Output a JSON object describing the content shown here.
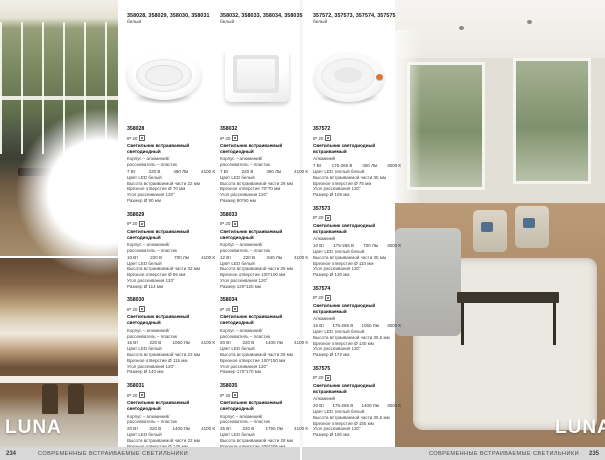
{
  "brand": "LUNA",
  "footer": {
    "left_page": "234",
    "right_page": "235",
    "section_title": "СОВРЕМЕННЫЕ ВСТРАИВАЕМЫЕ СВЕТИЛЬНИКИ"
  },
  "groups": [
    {
      "codes": "358028, 358029, 358030, 358031",
      "finish": "белый"
    },
    {
      "codes": "358032, 358033, 358034, 358035",
      "finish": "белый"
    },
    {
      "codes": "357572, 357573, 357574, 357575",
      "finish": "белый"
    }
  ],
  "columns": [
    {
      "products": [
        {
          "code": "358028",
          "ip": "IP 20",
          "title": "Светильник встраиваемый светодиодный",
          "material": "Корпус – алюминий/",
          "material2": "рассеиватель – пластик",
          "watt": "7 Вт",
          "volt": "220 В",
          "lumen": "490 Лм",
          "kelvin": "4100 К",
          "led_color": "Цвет LED белый",
          "height": "Высота встраиваемой части 22 мм",
          "cutout": "Врезное отверстие Ø 70 мм",
          "angle": "Угол рассеивания 120°",
          "size": "Размер Ø 90 мм"
        },
        {
          "code": "358029",
          "ip": "IP 20",
          "title": "Светильник встраиваемый светодиодный",
          "material": "Корпус – алюминий/",
          "material2": "рассеиватель – пластик",
          "watt": "10 Вт",
          "volt": "220 В",
          "lumen": "700 Лм",
          "kelvin": "4100 К",
          "led_color": "Цвет LED белый",
          "height": "Высота встраиваемой части 32 мм",
          "cutout": "Врезное отверстие Ø 85 мм",
          "angle": "Угол рассеивания 120°",
          "size": "Размер Ø 114 мм"
        },
        {
          "code": "358030",
          "ip": "IP 20",
          "title": "Светильник встраиваемый светодиодный",
          "material": "Корпус – алюминий/",
          "material2": "рассеиватель – пластик",
          "watt": "15 Вт",
          "volt": "220 В",
          "lumen": "1050 Лм",
          "kelvin": "4100 К",
          "led_color": "Цвет LED белый",
          "height": "Высота встраиваемой части 22 мм",
          "cutout": "Врезное отверстие Ø 115 мм",
          "angle": "Угол рассеивания 120°",
          "size": "Размер Ø 140 мм"
        },
        {
          "code": "358031",
          "ip": "IP 20",
          "title": "Светильник встраиваемый светодиодный",
          "material": "Корпус – алюминий/",
          "material2": "рассеиватель – пластик",
          "watt": "20 Вт",
          "volt": "220 В",
          "lumen": "1400 Лм",
          "kelvin": "4100 К",
          "led_color": "Цвет LED белый",
          "height": "Высота встраиваемой части 22 мм",
          "cutout": "Врезное отверстие Ø 145 мм",
          "angle": "Угол рассеивания 120°",
          "size": "Размер Ø 180 мм"
        }
      ]
    },
    {
      "products": [
        {
          "code": "358032",
          "ip": "IP 20",
          "title": "Светильник встраиваемый светодиодный",
          "material": "Корпус – алюминий/",
          "material2": "рассеиватель – пластик",
          "watt": "7 Вт",
          "volt": "220 В",
          "lumen": "490 Лм",
          "kelvin": "4100 К",
          "led_color": "Цвет LED белый",
          "height": "Высота встраиваемой части 28 мм",
          "cutout": "Врезное отверстие 70*70 мм",
          "angle": "Угол рассеивания 120°",
          "size": "Размер 90*90 мм"
        },
        {
          "code": "358033",
          "ip": "IP 20",
          "title": "Светильник встраиваемый светодиодный",
          "material": "Корпус – алюминий/",
          "material2": "рассеиватель – пластик",
          "watt": "12 Вт",
          "volt": "220 В",
          "lumen": "840 Лм",
          "kelvin": "4100 К",
          "led_color": "Цвет LED белый",
          "height": "Высота встраиваемой части 28 мм",
          "cutout": "Врезное отверстие 100*100 мм",
          "angle": "Угол рассеивания 120°",
          "size": "Размер 120*120 мм"
        },
        {
          "code": "358034",
          "ip": "IP 20",
          "title": "Светильник встраиваемый светодиодный",
          "material": "Корпус – алюминий/",
          "material2": "рассеиватель – пластик",
          "watt": "20 Вт",
          "volt": "220 В",
          "lumen": "1400 Лм",
          "kelvin": "4100 К",
          "led_color": "Цвет LED белый",
          "height": "Высота встраиваемой части 28 мм",
          "cutout": "Врезное отверстие 150*150 мм",
          "angle": "Угол рассеивания 120°",
          "size": "Размер 170*170 мм"
        },
        {
          "code": "358035",
          "ip": "IP 20",
          "title": "Светильник встраиваемый светодиодный",
          "material": "Корпус – алюминий/",
          "material2": "рассеиватель – пластик",
          "watt": "25 Вт",
          "volt": "220 В",
          "lumen": "1750 Лм",
          "kelvin": "4100 К",
          "led_color": "Цвет LED белый",
          "height": "Высота встраиваемой части 28 мм",
          "cutout": "Врезное отверстие 205*205 мм",
          "angle": "Угол рассеивания 120°",
          "size": "Размер 225*225 мм"
        }
      ]
    },
    {
      "products": [
        {
          "code": "357572",
          "ip": "IP 20",
          "title": "Светильник светодиодный встраиваемый",
          "material": "Алюминий",
          "material2": "",
          "watt": "7 Вт",
          "volt": "175-265 В",
          "lumen": "400 Лм",
          "kelvin": "3000 К",
          "led_color": "Цвет LED теплый белый",
          "height": "Высота встраиваемой части 35 мм",
          "cutout": "Врезное отверстие Ø 75 мм",
          "angle": "Угол рассеивания 130°",
          "size": "Размер Ø 108 мм"
        },
        {
          "code": "357573",
          "ip": "IP 20",
          "title": "Светильник светодиодный встраиваемый",
          "material": "Алюминий",
          "material2": "",
          "watt": "10 Вт",
          "volt": "175-265 В",
          "lumen": "700 Лм",
          "kelvin": "3000 К",
          "led_color": "Цвет LED теплый белый",
          "height": "Высота встраиваемой части 35 мм",
          "cutout": "Врезное отверстие Ø 110 мм",
          "angle": "Угол рассеивания 130°",
          "size": "Размер Ø 130 мм"
        },
        {
          "code": "357574",
          "ip": "IP 20",
          "title": "Светильник светодиодный встраиваемый",
          "material": "Алюминий",
          "material2": "",
          "watt": "15 Вт",
          "volt": "175-265 В",
          "lumen": "1050 Лм",
          "kelvin": "3000 К",
          "led_color": "Цвет LED теплый белый",
          "height": "Высота встраиваемой части 35,5 мм",
          "cutout": "Врезное отверстие Ø 140 мм",
          "angle": "Угол рассеивания 130°",
          "size": "Размер Ø 172 мм"
        },
        {
          "code": "357575",
          "ip": "IP 20",
          "title": "Светильник светодиодный встраиваемый",
          "material": "Алюминий",
          "material2": "",
          "watt": "20 Вт",
          "volt": "175-265 В",
          "lumen": "1400 Лм",
          "kelvin": "3000 К",
          "led_color": "Цвет LED теплый белый",
          "height": "Высота встраиваемой части 35,5 мм",
          "cutout": "Врезное отверстие Ø 155 мм",
          "angle": "Угол рассеивания 130°",
          "size": "Размер Ø 190 мм"
        }
      ]
    }
  ],
  "accent_color": "#e0742f"
}
